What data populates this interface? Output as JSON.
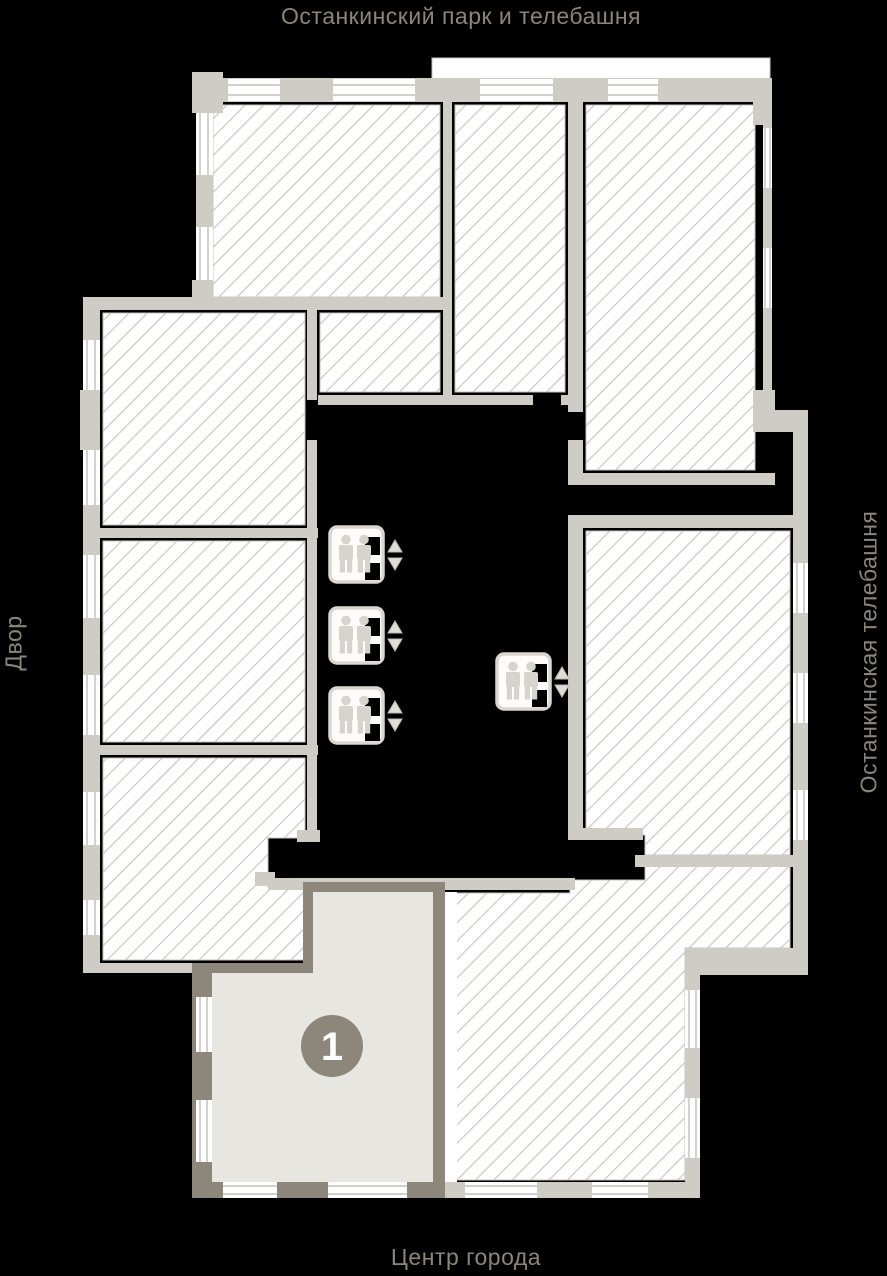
{
  "labels": {
    "top": "Останкинский парк и телебашня",
    "bottom": "Центр города",
    "left": "Двор",
    "right": "Останкинская телебашня"
  },
  "selected_apartment": {
    "number": "1"
  },
  "icons": {
    "elevator": "elevator-two-passengers-with-up-down-call-arrows",
    "elevator_count": 4
  },
  "colors": {
    "background": "#000000",
    "hatch_fill": "#ffffff",
    "hatch_line": "#ccc8c1",
    "unit_outline": "#c9c5be",
    "wall_light": "#cfccc5",
    "wall_dark": "#8d867a",
    "selected_fill": "#e8e6e1",
    "window_line": "#b8b4ae",
    "badge_fill": "#8d867a",
    "badge_text": "#ffffff",
    "label_text": "#8b857a"
  }
}
